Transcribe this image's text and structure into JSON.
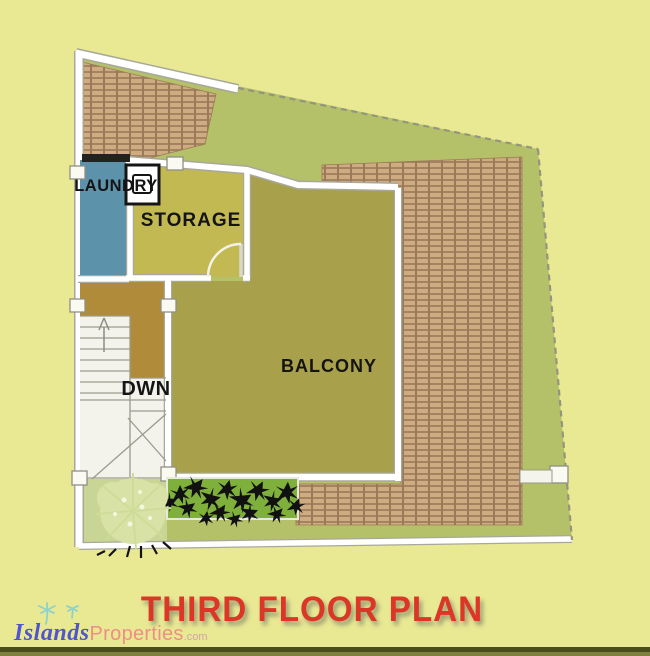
{
  "title": {
    "text": "THIRD FLOOR PLAN"
  },
  "logo": {
    "islands": "Islands",
    "properties": "Properties",
    "tld": ".com"
  },
  "plan": {
    "labels": {
      "laundry": "LAUNDRY",
      "storage": "STORAGE",
      "balcony": "BALCONY",
      "stairs": "DWN"
    }
  },
  "colors": {
    "site_bg": "#e9e994",
    "lawn": "#b5c168",
    "lawn_light": "#c9d594",
    "brick_face": "#cfab82",
    "brick_gap": "#9a7a58",
    "laundry_blue": "#5d93aa",
    "storage_olive": "#c3b952",
    "balcony_olive": "#a9a04c",
    "landing_mustard": "#b08c3a",
    "stairs_white": "#f3f3ec",
    "wall_edge": "#a8a89a",
    "hedge_green": "#7fb03c",
    "plant_black": "#111111",
    "shrub_pale": "#d8e2a6",
    "title_red": "#dc3726",
    "logo_blue": "#5055cc",
    "logo_pink": "#ef8e86",
    "logo_gray": "#d0a2ac",
    "logo_teal": "#8ed2cc",
    "border_dark": "#4b4c1c",
    "border_mid": "#7e8040",
    "label_ink": "#141414"
  }
}
